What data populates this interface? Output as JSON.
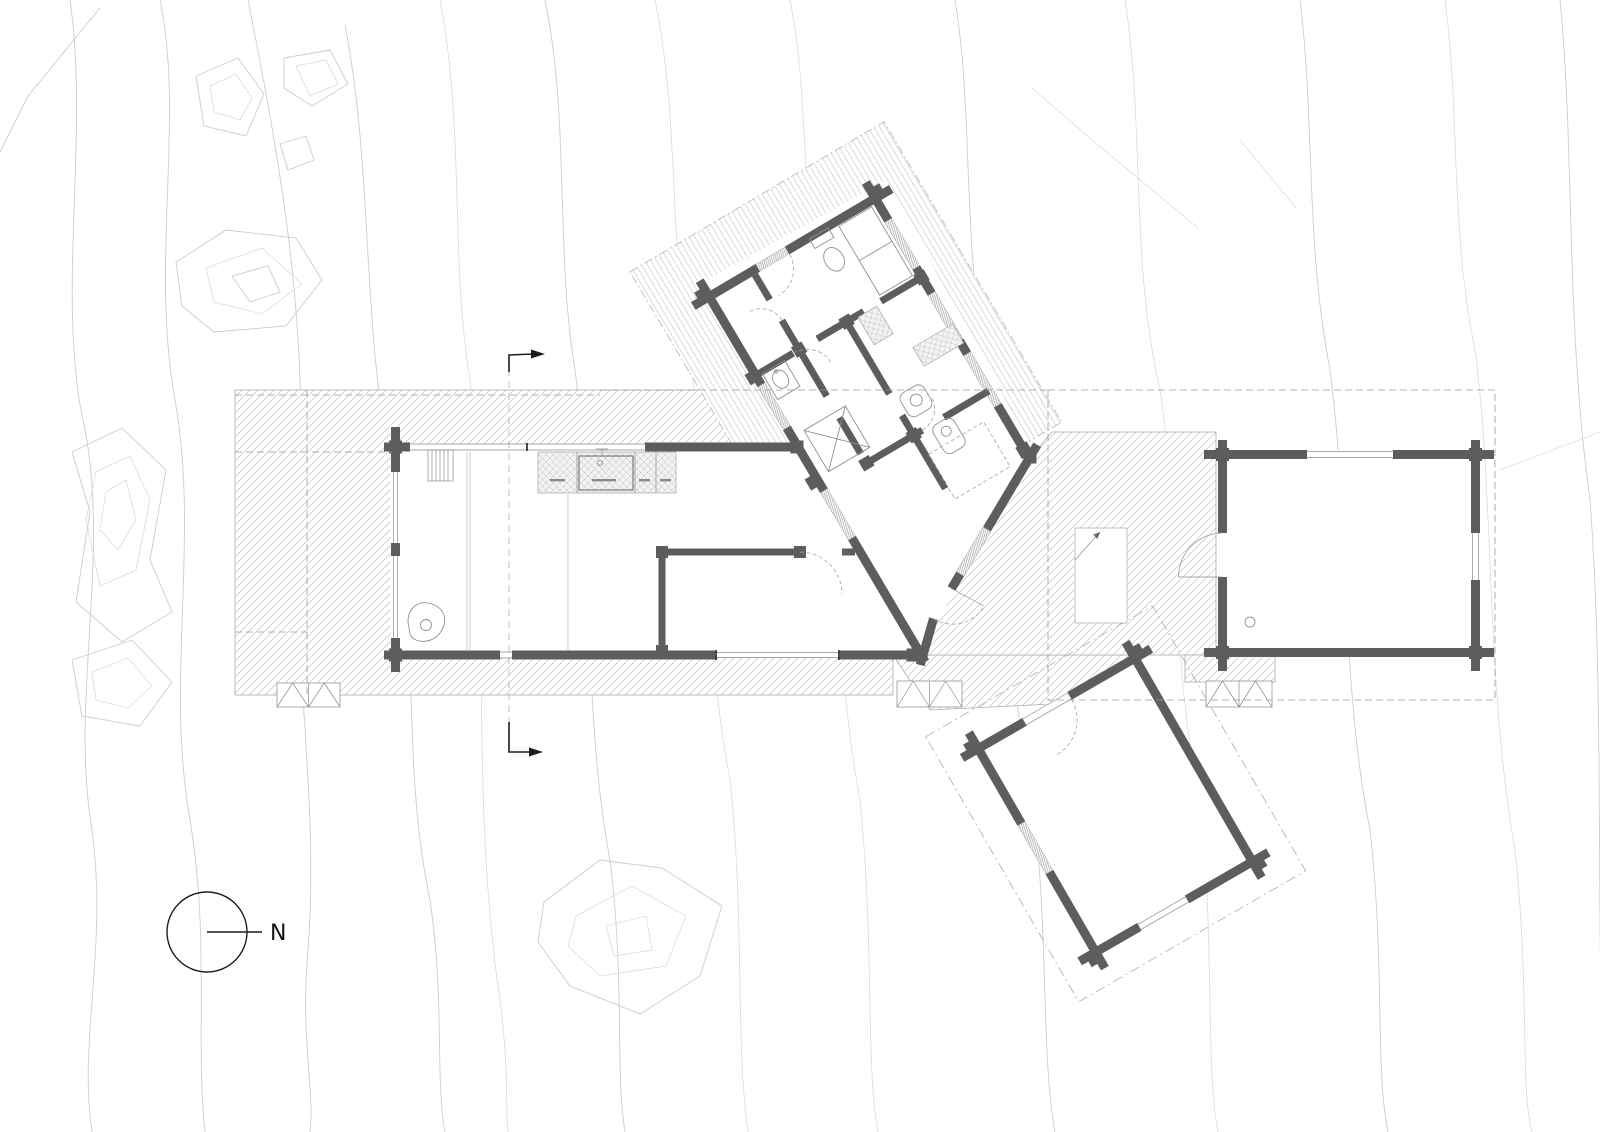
{
  "drawing": {
    "type": "architectural site / floor plan",
    "north_indicator": {
      "label": "N"
    }
  },
  "components": {
    "main_cabin": "living cabin with kitchen, fireplace and bedroom",
    "bedroom_wing": "rotated wing with bathrooms and bedrooms",
    "guest_cabin": "rectangular outbuilding, right side",
    "sauna_cabin": "rotated outbuilding, lower right",
    "deck": "hatched terrace decks and connecting walkway",
    "steps": "three exterior stair treads at deck edge",
    "section_markers": "section cut line with two corner arrows",
    "contours": "site topography contour lines"
  },
  "colors": {
    "wall": "#5d5d5d",
    "hatch": "#c3c3c3",
    "contour": "#cccccc",
    "dashed": "#9a9a9a",
    "background": "#ffffff"
  }
}
